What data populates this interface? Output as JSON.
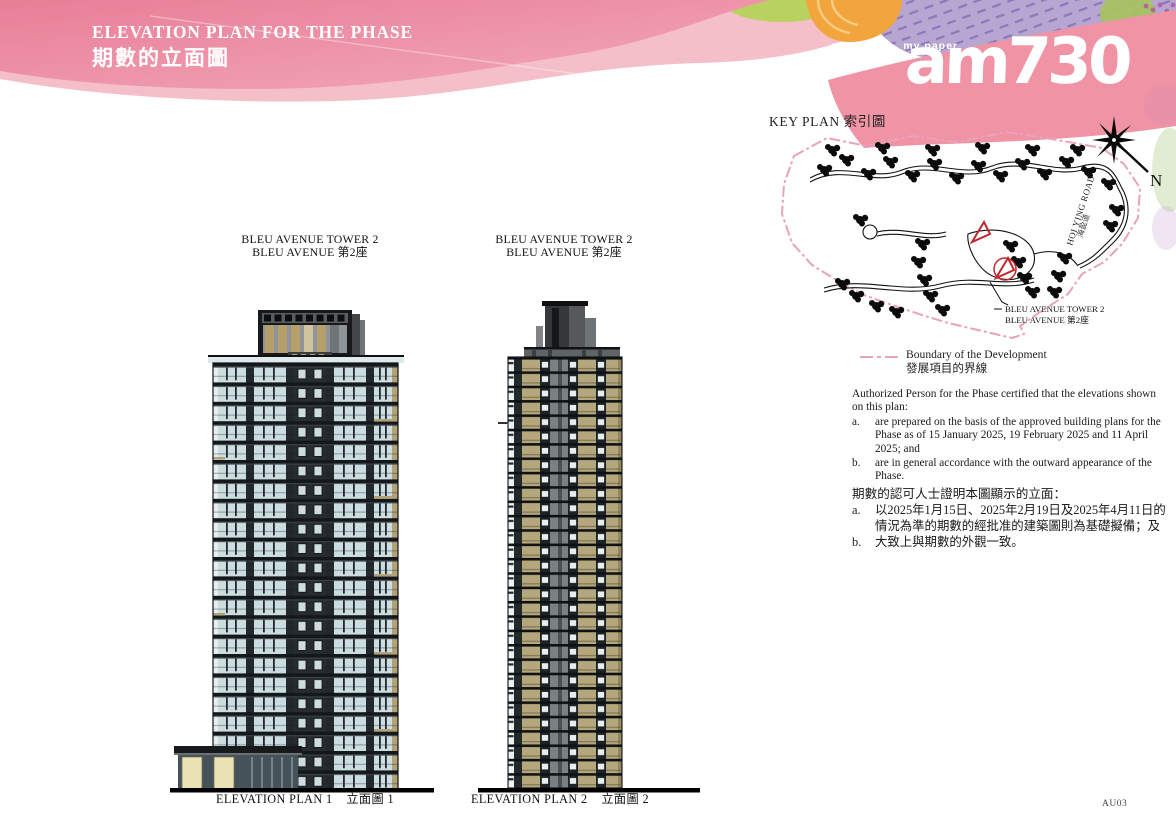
{
  "header": {
    "title_en": "ELEVATION PLAN FOR THE PHASE",
    "title_zh": "期數的立面圖"
  },
  "logo": {
    "tagline": "my choice . my paper",
    "brand": "am730"
  },
  "key_plan": {
    "title": "KEY PLAN 索引圖",
    "north": "N",
    "road_en": "HOI YING ROAD",
    "road_zh": "海盈道",
    "callout_en": "BLEU AVENUE TOWER 2",
    "callout_zh": "BLEU AVENUE  第2座"
  },
  "legend": {
    "en": "Boundary of the Development",
    "zh": "發展項目的界線"
  },
  "towers": [
    {
      "name_en": "BLEU AVENUE TOWER 2",
      "name_zh": "BLEU AVENUE  第2座",
      "plan_en": "ELEVATION PLAN 1",
      "plan_zh": "立面圖 1"
    },
    {
      "name_en": "BLEU AVENUE TOWER 2",
      "name_zh": "BLEU AVENUE  第2座",
      "plan_en": "ELEVATION PLAN 2",
      "plan_zh": "立面圖 2"
    }
  ],
  "cert": {
    "intro_en": "Authorized Person for the Phase certified that the elevations shown on this plan:",
    "a_marker": "a.",
    "b_marker": "b.",
    "a_en": "are prepared on the basis of the approved building plans for the Phase as of 15 January 2025, 19 February 2025 and 11 April 2025; and",
    "b_en": "are in general accordance with the outward appearance of the Phase.",
    "intro_zh": "期數的認可人士證明本圖顯示的立面：",
    "a_zh": "以2025年1月15日、2025年2月19日及2025年4月11日的情況為準的期數的經批准的建築圖則為基礎擬備；及",
    "b_zh": "大致上與期數的外觀一致。"
  },
  "footer": {
    "code": "AU03"
  },
  "colors": {
    "header_pink": "#ec8ba0",
    "header_pink_light": "#f5bfca",
    "band_pink": "#ef93a5",
    "purple": "#b7a6d2",
    "green": "#b9d15e",
    "orange": "#f3a53d",
    "boundary_pink": "#e8a3bd",
    "glass_blue": "#ccdde0",
    "frame_dark": "#23282c",
    "tan": "#b3a276",
    "tower2_tan": "#b5a77c",
    "cream": "#e9e2b5",
    "gray_core": "#7b8083",
    "red_marker": "#c1272d"
  }
}
